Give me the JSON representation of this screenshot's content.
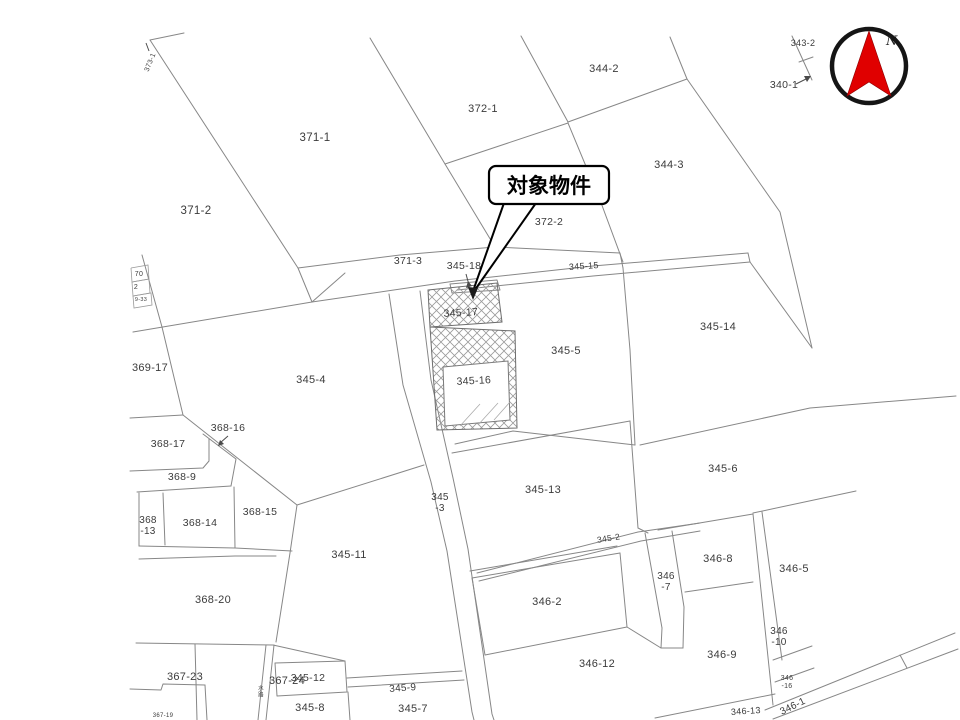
{
  "title": "cadastral-parcel-map",
  "callout": {
    "label": "対象物件"
  },
  "compass": {
    "north_label": "N",
    "needle_color": "#e00000",
    "ring_color": "#151515"
  },
  "map": {
    "line_color": "#878787",
    "label_color": "#3b3b3b",
    "hatched_parcels": [
      "345-17",
      "345-16"
    ],
    "labels": [
      {
        "lines": [
          "373-1"
        ],
        "x": 152,
        "y": 63,
        "size": 7,
        "rot": -68
      },
      {
        "lines": [
          "343-2"
        ],
        "x": 803,
        "y": 46,
        "size": 9
      },
      {
        "lines": [
          "340-1"
        ],
        "x": 784,
        "y": 88,
        "size": 10.5
      },
      {
        "lines": [
          "344-2"
        ],
        "x": 604,
        "y": 72,
        "size": 11
      },
      {
        "lines": [
          "372-1"
        ],
        "x": 483,
        "y": 112,
        "size": 11
      },
      {
        "lines": [
          "371-1"
        ],
        "x": 315,
        "y": 141,
        "size": 11.5
      },
      {
        "lines": [
          "344-3"
        ],
        "x": 669,
        "y": 168,
        "size": 11
      },
      {
        "lines": [
          "371-2"
        ],
        "x": 196,
        "y": 214,
        "size": 11.5
      },
      {
        "lines": [
          "372-2"
        ],
        "x": 549,
        "y": 225,
        "size": 10.5
      },
      {
        "lines": [
          "371-3"
        ],
        "x": 408,
        "y": 264,
        "size": 10.5
      },
      {
        "lines": [
          "345-18"
        ],
        "x": 464,
        "y": 269,
        "size": 10.5
      },
      {
        "lines": [
          "345-15"
        ],
        "x": 584,
        "y": 269,
        "size": 9,
        "rot": -4
      },
      {
        "lines": [
          "345-17"
        ],
        "x": 461,
        "y": 316,
        "size": 10.5,
        "rot": -3
      },
      {
        "lines": [
          "345-14"
        ],
        "x": 718,
        "y": 330,
        "size": 11
      },
      {
        "lines": [
          "345-5"
        ],
        "x": 566,
        "y": 354,
        "size": 11
      },
      {
        "lines": [
          "369-17"
        ],
        "x": 150,
        "y": 371,
        "size": 11
      },
      {
        "lines": [
          "345-4"
        ],
        "x": 311,
        "y": 383,
        "size": 11
      },
      {
        "lines": [
          "368-16"
        ],
        "x": 228,
        "y": 431,
        "size": 10.5
      },
      {
        "lines": [
          "368-17"
        ],
        "x": 168,
        "y": 447,
        "size": 10.5
      },
      {
        "lines": [
          "345-16"
        ],
        "x": 474,
        "y": 384,
        "size": 10.5,
        "rot": -3
      },
      {
        "lines": [
          "368-9"
        ],
        "x": 182,
        "y": 480,
        "size": 10.5
      },
      {
        "lines": [
          "345-6"
        ],
        "x": 723,
        "y": 472,
        "size": 11
      },
      {
        "lines": [
          "368",
          "-13"
        ],
        "x": 148,
        "y": 523,
        "size": 10
      },
      {
        "lines": [
          "368-14"
        ],
        "x": 200,
        "y": 526,
        "size": 10.5
      },
      {
        "lines": [
          "368-15"
        ],
        "x": 260,
        "y": 515,
        "size": 10.5
      },
      {
        "lines": [
          "345-13"
        ],
        "x": 543,
        "y": 493,
        "size": 11
      },
      {
        "lines": [
          "345",
          "-3"
        ],
        "x": 440,
        "y": 500,
        "size": 10
      },
      {
        "lines": [
          "345-11"
        ],
        "x": 349,
        "y": 558,
        "size": 11
      },
      {
        "lines": [
          "345-2"
        ],
        "x": 609,
        "y": 541,
        "size": 8.5,
        "rot": -9
      },
      {
        "lines": [
          "368-20"
        ],
        "x": 213,
        "y": 603,
        "size": 11
      },
      {
        "lines": [
          "346-8"
        ],
        "x": 718,
        "y": 562,
        "size": 11
      },
      {
        "lines": [
          "346-5"
        ],
        "x": 794,
        "y": 572,
        "size": 11
      },
      {
        "lines": [
          "346",
          "-7"
        ],
        "x": 666,
        "y": 579,
        "size": 10
      },
      {
        "lines": [
          "346-2"
        ],
        "x": 547,
        "y": 605,
        "size": 11
      },
      {
        "lines": [
          "346-12"
        ],
        "x": 597,
        "y": 667,
        "size": 11
      },
      {
        "lines": [
          "346-9"
        ],
        "x": 722,
        "y": 658,
        "size": 11
      },
      {
        "lines": [
          "346",
          "-10"
        ],
        "x": 779,
        "y": 634,
        "size": 10
      },
      {
        "lines": [
          "367-23"
        ],
        "x": 185,
        "y": 680,
        "size": 11
      },
      {
        "lines": [
          "367-24"
        ],
        "x": 287,
        "y": 684,
        "size": 11
      },
      {
        "lines": [
          "345-12"
        ],
        "x": 308,
        "y": 681,
        "size": 10.5
      },
      {
        "lines": [
          "345-9"
        ],
        "x": 403,
        "y": 691,
        "size": 10,
        "rot": -4
      },
      {
        "lines": [
          "345-8"
        ],
        "x": 310,
        "y": 711,
        "size": 11
      },
      {
        "lines": [
          "345-7"
        ],
        "x": 413,
        "y": 712,
        "size": 11
      },
      {
        "lines": [
          "346",
          "-16"
        ],
        "x": 787,
        "y": 680,
        "size": 7
      },
      {
        "lines": [
          "346-1"
        ],
        "x": 794,
        "y": 709,
        "size": 10,
        "rot": -26
      },
      {
        "lines": [
          "346-13"
        ],
        "x": 746,
        "y": 714,
        "size": 9,
        "rot": -4
      },
      {
        "lines": [
          "70"
        ],
        "x": 139,
        "y": 276,
        "size": 7
      },
      {
        "lines": [
          "2"
        ],
        "x": 136,
        "y": 289,
        "size": 7
      },
      {
        "lines": [
          "9-33"
        ],
        "x": 141,
        "y": 301,
        "size": 5.5
      },
      {
        "lines": [
          "水",
          "路"
        ],
        "x": 261,
        "y": 690,
        "size": 5.5
      },
      {
        "lines": [
          "367-19"
        ],
        "x": 163,
        "y": 717,
        "size": 6
      }
    ]
  }
}
